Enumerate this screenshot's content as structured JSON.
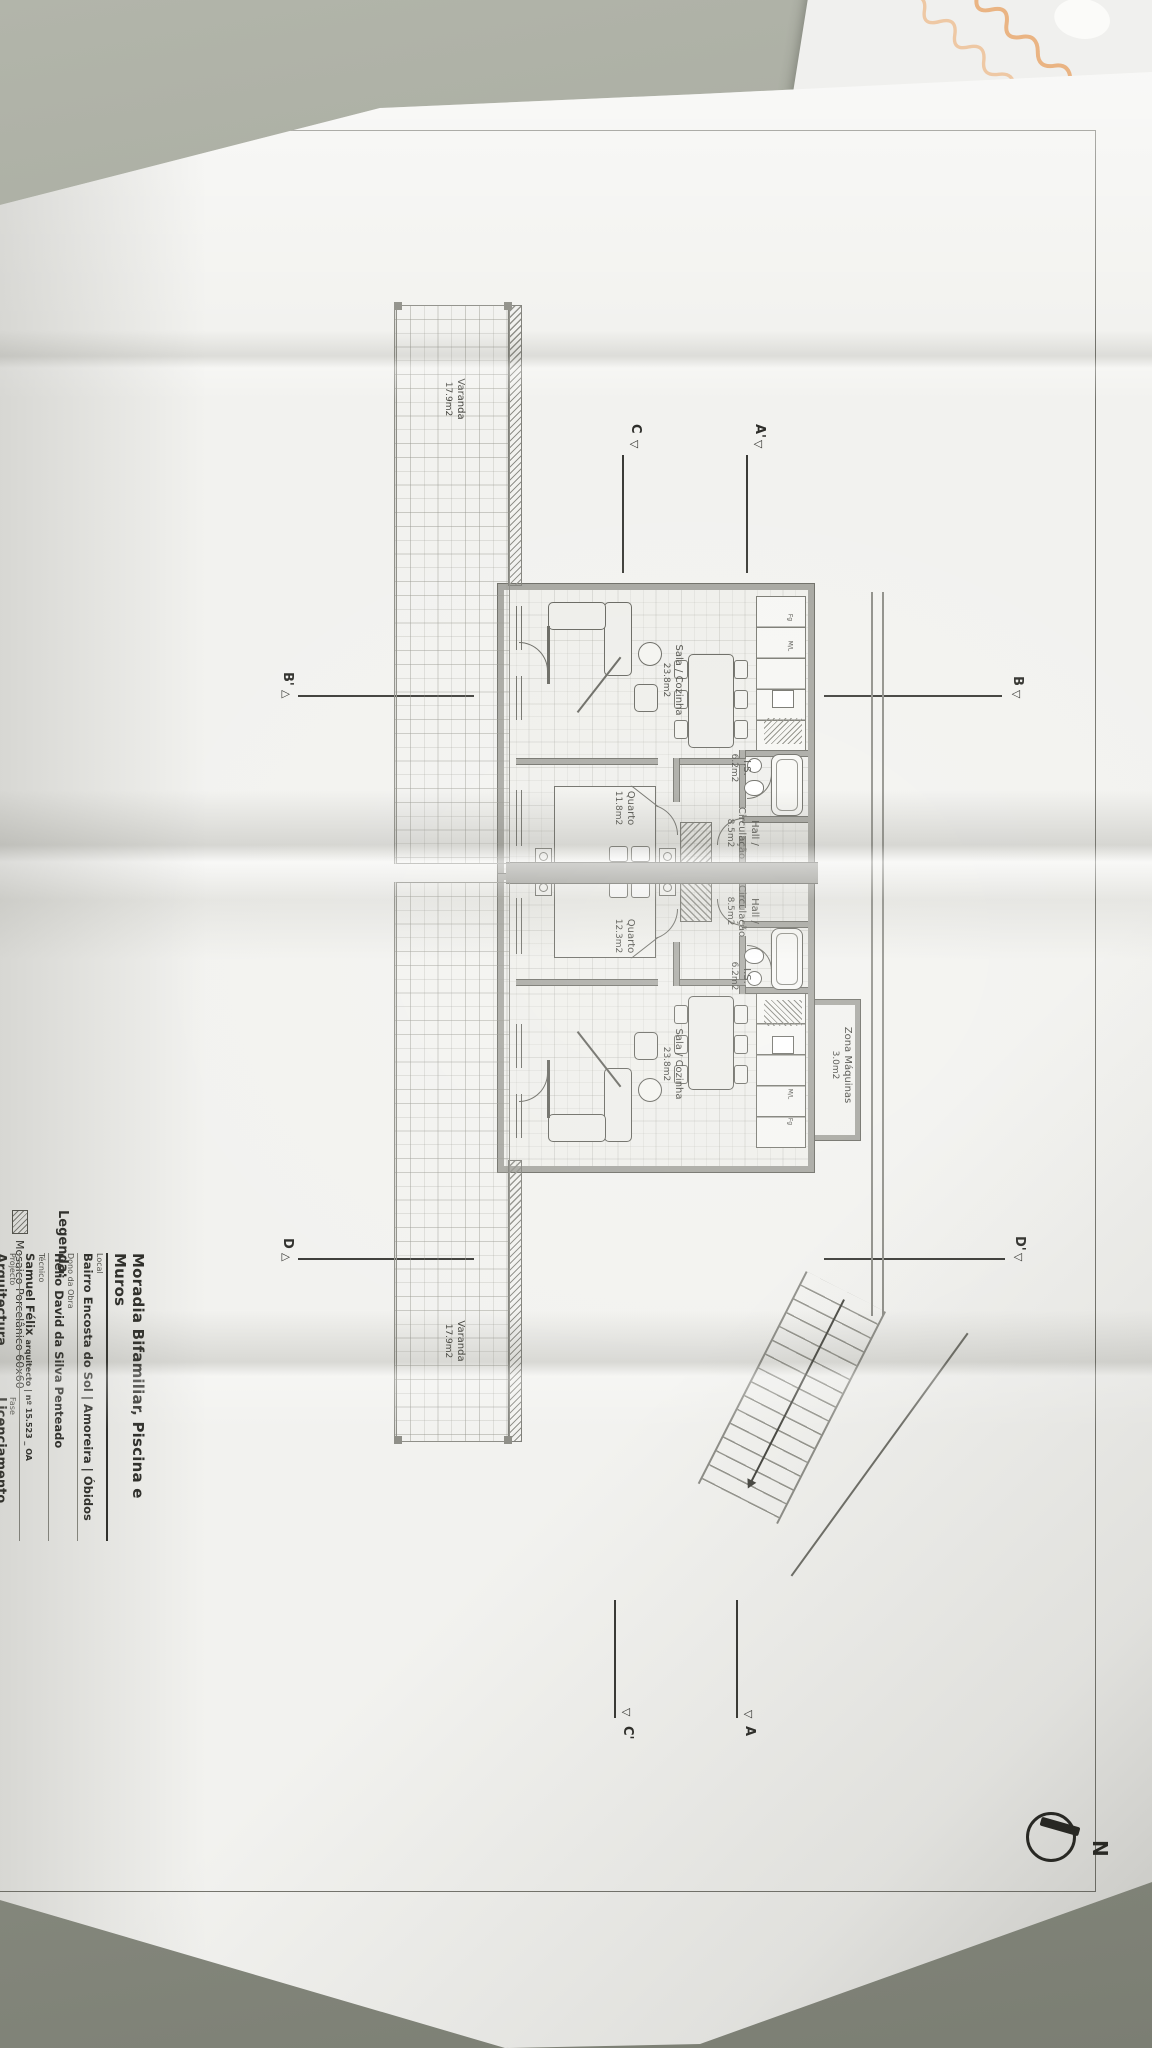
{
  "colors": {
    "desk": "#9a9d92",
    "paper": "#f2f2ef",
    "ink": "#3c3c38",
    "wall_gray": "#a5a59f",
    "script_orange": "#e8a263"
  },
  "titleblock": {
    "title": "Moradia Bifamiliar, Piscina e Muros",
    "rows": [
      {
        "label": "Local",
        "value": "Bairro Encosta do Sol | Amoreira | Óbidos"
      },
      {
        "label": "Dono da Obra",
        "value": "Hélio David da Silva Penteado"
      },
      {
        "label": "Técnico",
        "value": "Samuel Félix",
        "value_suffix": "arquitecto | nº 15.523 _ OA"
      },
      {
        "label": "Projecto",
        "value": "Arquitectura"
      },
      {
        "label": "Fase",
        "value": "Licenciamento"
      }
    ]
  },
  "legend": {
    "heading": "Legenda:",
    "item": "Mosaico Porcelânico 60x60"
  },
  "plan": {
    "compass_label": "N",
    "markers": {
      "a_left": "A'",
      "a_right": "A",
      "c_left": "C",
      "c_right": "C'",
      "b_top": "B",
      "b_bottom": "B'",
      "d_top": "D'",
      "d_bottom": "D"
    },
    "triangle_down": "▽",
    "triangle_up": "△",
    "shared_room": {
      "name": "Zona Máquinas",
      "area": "3.0m2"
    },
    "unit_a": {
      "sala": {
        "name": "Sala / Cozinha",
        "area": "23.8m2"
      },
      "hall": {
        "line1": "Hall /",
        "line2": "Circulação",
        "area": "8.5m2"
      },
      "is": {
        "name": "I.S.",
        "area": "6.2m2"
      },
      "quarto": {
        "name": "Quarto",
        "area": "11.8m2"
      },
      "varanda": {
        "name": "Varanda",
        "area": "17.9m2"
      },
      "kitchen": {
        "fridge": "Fg",
        "washer": "M/L"
      }
    },
    "unit_b": {
      "sala": {
        "name": "Sala / Cozinha",
        "area": "23.8m2"
      },
      "hall": {
        "line1": "Hall /",
        "line2": "Circulação",
        "area": "8.5m2"
      },
      "is": {
        "name": "I.S.",
        "area": "6.2m2"
      },
      "quarto": {
        "name": "Quarto",
        "area": "12.3m2"
      },
      "varanda": {
        "name": "Varanda",
        "area": "17.9m2"
      },
      "kitchen": {
        "fridge": "Fg",
        "washer": "M/L"
      }
    }
  }
}
